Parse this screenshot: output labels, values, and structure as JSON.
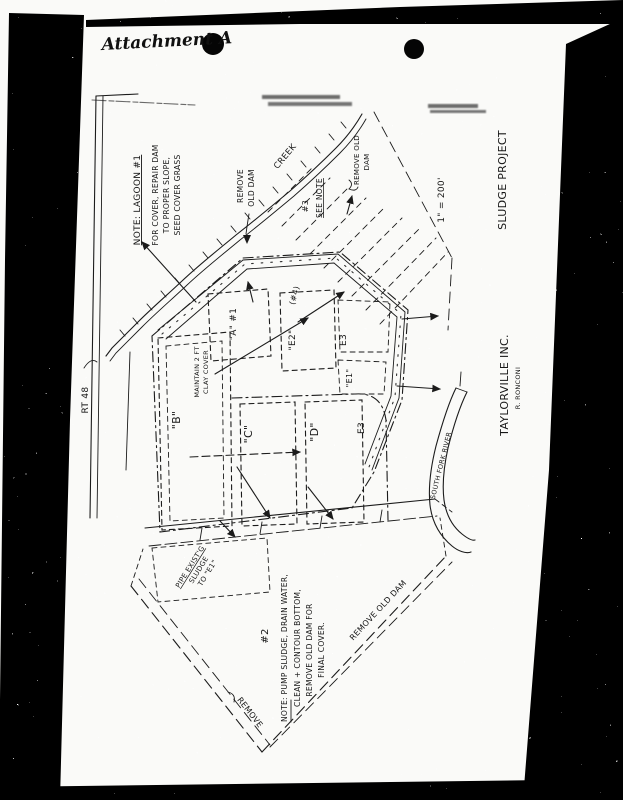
{
  "doc": {
    "attachment": "Attachment A",
    "title": {
      "company": "TAYLORVILLE INC.",
      "engineer": "R. RONCONI",
      "project": "SLUDGE PROJECT",
      "scale": "1\" = 200'"
    },
    "labels": {
      "road": "RT 48",
      "creek": "CREEK",
      "river": "SOUTH FORK RIVER",
      "remove_word": "REMOVE",
      "old_dam_word": "OLD DAM",
      "remove_old_2a": "REMOVE OLD",
      "remove_old_2b": "DAM",
      "remove_old_dam": "REMOVE OLD DAM",
      "remove": "REMOVE",
      "see_note": "SEE NOTE",
      "note3_ref": "#3",
      "marker4": "(#4)",
      "maintain1": "MAINTAIN 2 FT",
      "maintain2": "CLAY COVER",
      "pipe1": "PIPE EXIST'G",
      "pipe2": "SLUDGE",
      "pipe3": "TO \"E1\""
    },
    "cells": {
      "a": "\"A\" #1",
      "b": "\"B\"",
      "c": "\"C\"",
      "d": "\"D\"",
      "e1": "\"E1\"",
      "e2": "\"E2\"",
      "e3u": "E3",
      "e3l": "E3"
    },
    "note1": {
      "heading": "NOTE: LAGOON #1",
      "line1": "FOR COVER, REPAIR DAM",
      "line2": "TO PROPER SLOPE,",
      "line3": "SEED COVER GRASS"
    },
    "note2": {
      "ref": "#2",
      "line1": "NOTE: PUMP SLUDGE, DRAIN WATER,",
      "line2": "CLEAN + CONTOUR BOTTOM,",
      "line3": "REMOVE OLD DAM FOR",
      "line4": "FINAL COVER."
    },
    "colors": {
      "ink": "#1b1b1b",
      "paper": "#fafaf8",
      "scan_black": "#000000"
    }
  }
}
